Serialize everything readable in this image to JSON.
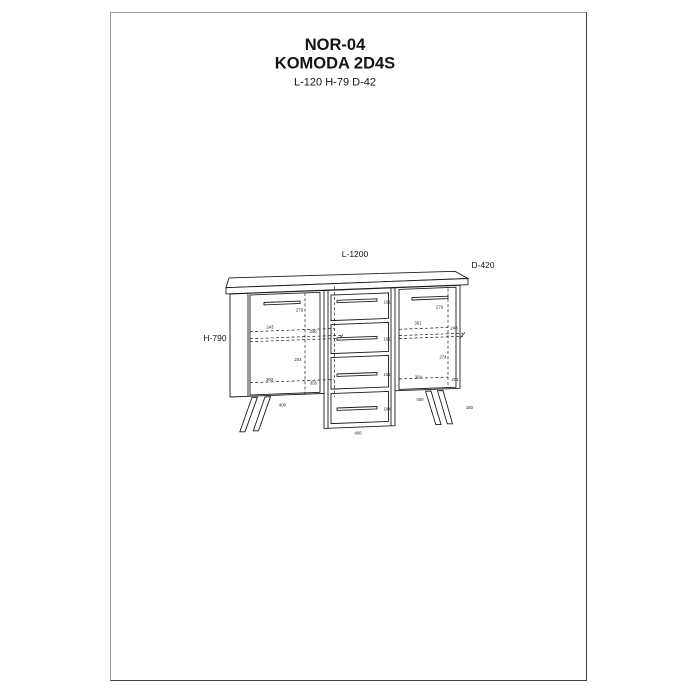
{
  "header": {
    "code": "NOR-04",
    "name": "KOMODA 2D4S",
    "dims": "L-120 H-79 D-42"
  },
  "drawing": {
    "dim_length": "L-1200",
    "dim_depth": "D-420",
    "dim_height": "H-790",
    "annotations": {
      "left_handle": "279",
      "left_shelf": "243",
      "left_shelf_end": "340",
      "left_mid": "254",
      "left_bottom": "393",
      "left_bottom_end": "355",
      "left_base": "400",
      "drawer1": "161",
      "drawer2": "161",
      "drawer3": "161",
      "drawer4": "184",
      "right_handle": "279",
      "right_shelf": "361",
      "right_shelf_end": "248",
      "right_mid": "274",
      "right_bottom": "364",
      "right_bottom_end": "201",
      "right_base": "400",
      "leg_height": "180",
      "base_center": "400"
    }
  }
}
